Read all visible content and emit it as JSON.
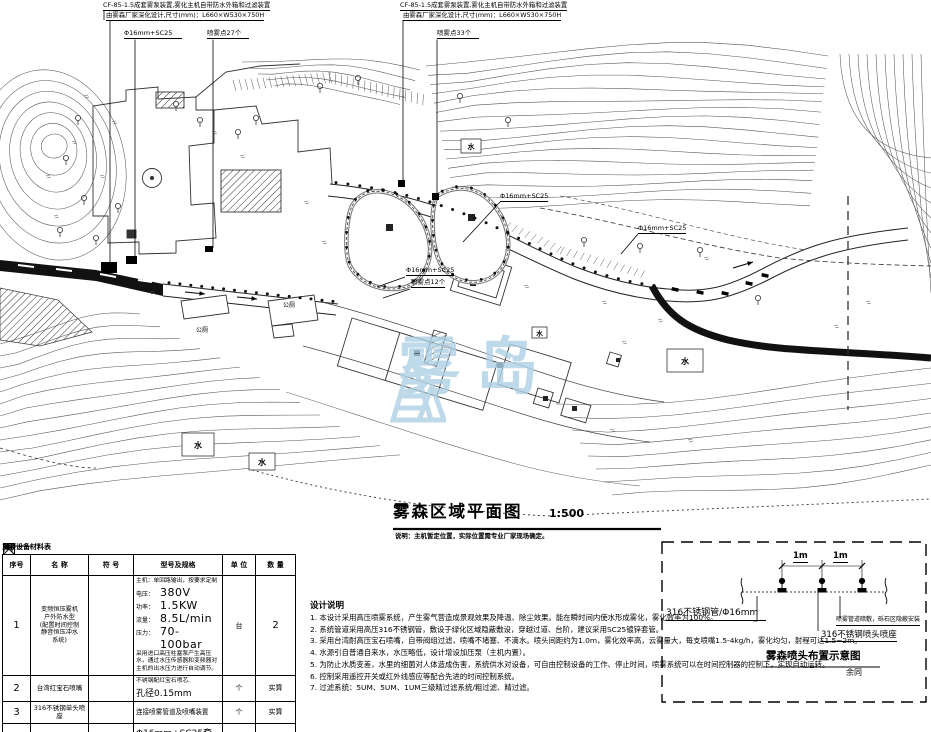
{
  "ann_left": {
    "line1": "CF-85-1.5成套雾泵装置,雾化主机自带防水外箱和过滤装置",
    "line2": "由雾森厂家深化设计,尺寸(mm)：L660×W530×750H",
    "pipe": "Φ16mm+SC25",
    "spray": "喷雾点27个"
  },
  "ann_mid": {
    "line1": "CF-85-1.5成套雾泵装置,雾化主机自带防水外箱和过滤装置",
    "line2": "由雾森厂家深化设计,尺寸(mm)：L660×W530×750H",
    "spray": "喷雾点33个"
  },
  "plan": {
    "pipe_a": "Φ16mm+SC25",
    "pipe_b": "Φ16mm+SC25",
    "pipe_c": "Φ16mm+SC25",
    "spray_c": "喷雾点12个",
    "water": "水",
    "toilet": "公厕",
    "watermark": "雾岛"
  },
  "title_block": {
    "title": "雾森区域平面图",
    "scale": "1:500",
    "note": "说明：主机暂定位置，实际位置需专业厂家现场确定。"
  },
  "equip_table": {
    "caption": "主要设备材料表",
    "headers": {
      "no": "序号",
      "name": "名  称",
      "symbol": "符  号",
      "spec": "型号及规格",
      "unit": "单  位",
      "qty": "数  量"
    },
    "row1": {
      "no": "1",
      "name1": "变频恒压雾机",
      "name2": "户外防水型",
      "name3": "(配置时间控制",
      "name4": "静音恒压冲水",
      "name5": "系统)",
      "spec_head": "主机：单回路输出，按要求定制",
      "p1l": "电压：",
      "p1v": "380V",
      "p2l": "功率：",
      "p2v": "1.5KW",
      "p3l": "流量：",
      "p3v": "8.5L/min",
      "p4l": "压力：",
      "p4v": "70-100bar",
      "spec_tail": "采用进口高压柱塞泵产生高压水，通过水压传感器和变频器对主机的出水压力进行自动调节。",
      "unit": "台",
      "qty": "2"
    },
    "row2": {
      "no": "2",
      "name": "台湾红宝石喷嘴",
      "spec1": "不锈钢配红宝石喷芯,",
      "spec2": "孔径0.15mm",
      "unit": "个",
      "qty": "实算"
    },
    "row3": {
      "no": "3",
      "name": "316不锈钢单头喷座",
      "spec": "连接喷雾管道及喷嘴装置",
      "unit": "个",
      "qty": "实算"
    },
    "row4": {
      "no": "4",
      "name": "高压316不锈钢+PC",
      "spec1": "Φ16mm+SC25套管",
      "spec2": "不锈钢管",
      "unit": "米",
      "qty": "实算"
    }
  },
  "notes": {
    "title": "设计说明",
    "items": [
      "1. 本设计采用高压喷雾系统，产生雾气营造成景观效果及降温、除尘效果。能在瞬时间内使水形成雾化，雾化效率为100%。",
      "2. 系统管道采用高压316不锈钢管，敷设于绿化区域隐蔽敷设，穿越过道、台阶，建议采用SC25镀锌套管。",
      "3. 采用台湾耐高压宝石喷嘴，自带阀组过滤，喷嘴不堵塞、不滴水。喷头间距约为1.0m，雾化效率高，云雾量大，每支喷嘴1.5-4kg/h，雾化均匀，射程可达1.5~2m。",
      "4. 水源引自普通自来水，水压略低，设计增设加压泵（主机内置）。",
      "5. 为防止水质变差，水里的细菌对人体造成伤害，系统供水对设备，可自由控制设备的工作、停止时间，喷雾系统可以在时间控制器的控制下，实现自动运转。",
      "6. 控制采用遥控开关或红外线感应等配合先进的时间控制系统。",
      "7. 过滤系统：5UM、5UM、1UM三级精过滤系统/粗过滤、精过滤。"
    ]
  },
  "detail": {
    "dim1": "1m",
    "dim2": "1m",
    "pipe_label": "316不锈钢管/Φ16mm",
    "laying_label": "喷雾管道暗敷，砾石区隐蔽安装",
    "nozzle_label": "316不锈钢喷头喷座",
    "title": "雾森喷头布置示意图",
    "subtitle": "余同"
  }
}
